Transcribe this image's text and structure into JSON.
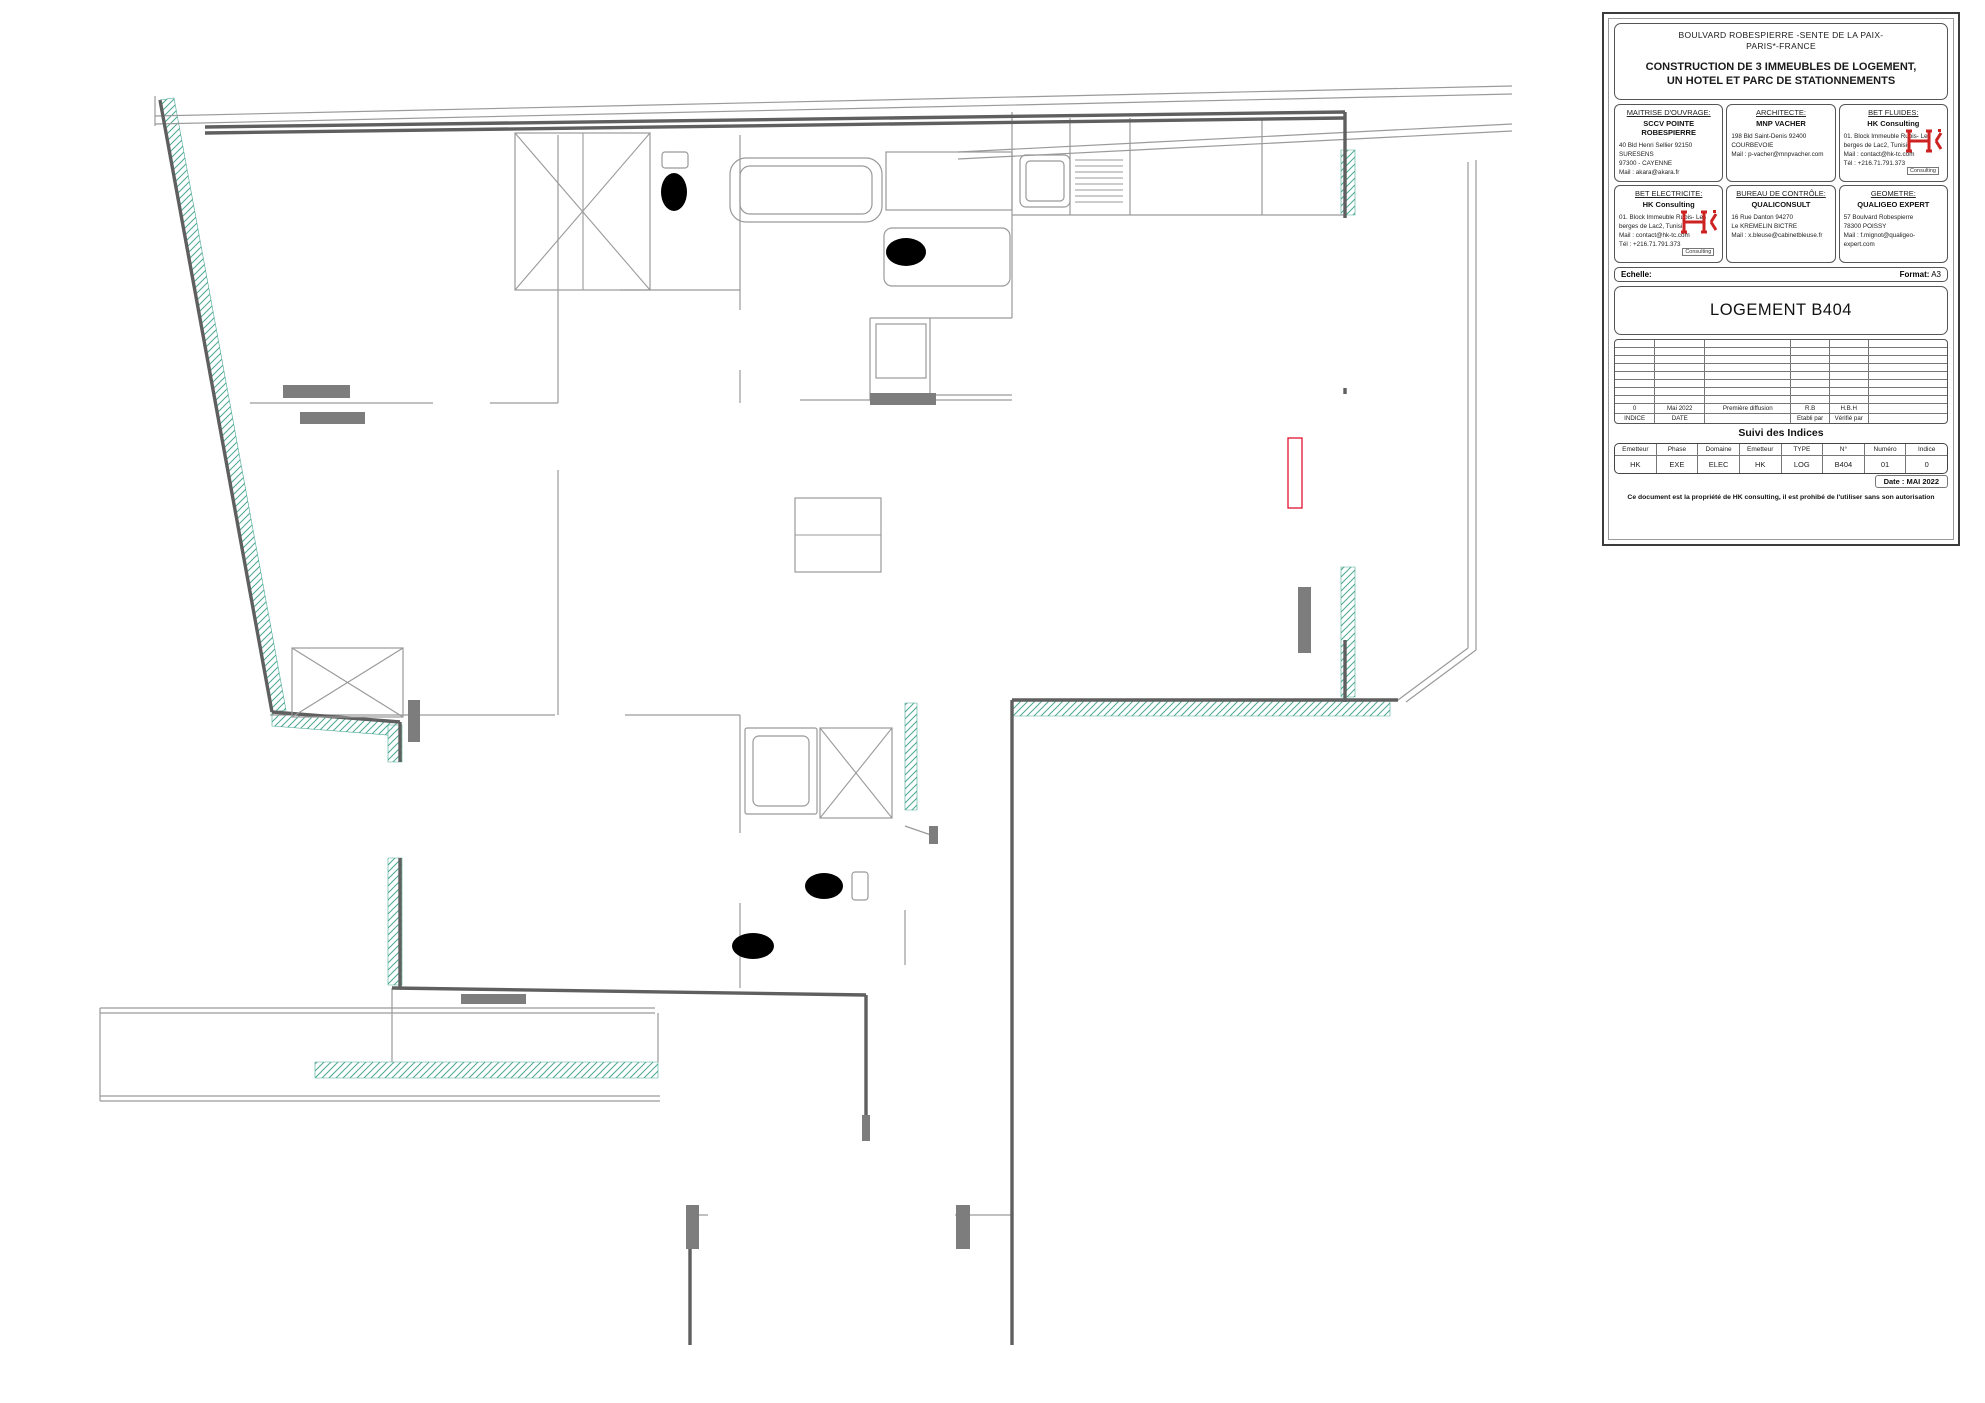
{
  "title_block": {
    "project_line1": "BOULVARD ROBESPIERRE -SENTE DE LA PAIX-",
    "project_line2": "PARIS*-FRANCE",
    "project_title1": "CONSTRUCTION DE 3 IMMEUBLES DE LOGEMENT,",
    "project_title2": "UN HOTEL ET PARC DE STATIONNEMENTS",
    "stakeholders": [
      {
        "role": "MAITRISE D'OUVRAGE:",
        "name": "SCCV POINTE ROBESPIERRE",
        "lines": [
          "40 Bld Henri Sellier 92150 SURESENS",
          "97300 - CAYENNE",
          "Mail : akara@akara.fr"
        ],
        "logo": false
      },
      {
        "role": "ARCHITECTE:",
        "name": "MNP VACHER",
        "lines": [
          "198 Bld Saint-Denis 92400",
          "COURBEVOIE",
          "Mail : p-vacher@mnpvacher.com"
        ],
        "logo": false
      },
      {
        "role": "BET FLUIDES:",
        "name": "HK Consulting",
        "lines": [
          "01. Block Immeuble Rubis- Les",
          "berges de Lac2, Tunisie",
          "Mail : contact@hk-tc.com",
          "Tél : +216.71.791.373"
        ],
        "logo": true
      },
      {
        "role": "BET ELECTRICITE:",
        "name": "HK Consulting",
        "lines": [
          "01. Block Immeuble Rubis- Les",
          "berges de Lac2, Tunisie",
          "Mail : contact@hk-tc.com",
          "Tél : +216.71.791.373"
        ],
        "logo": true
      },
      {
        "role": "BUREAU DE CONTRÔLE:",
        "name": "QUALICONSULT",
        "lines": [
          "16 Rue Danton 94270",
          "Le KREMELIN BICTRE",
          "Mail : x.bleuse@cabinetbleuse.fr"
        ],
        "logo": false
      },
      {
        "role": "GEOMETRE:",
        "name": "QUALIGEO EXPERT",
        "lines": [
          "57 Boulvard Robespierre",
          "78300 POISSY",
          "Mail : f.mignot@qualigeo-expert.com"
        ],
        "logo": false
      }
    ],
    "logo_text": "Consulting",
    "echelle_label": "Echelle:",
    "format_label": "Format:",
    "format_value": "A3",
    "drawing_title": "LOGEMENT B404",
    "revision_filled": [
      "0",
      "Mai 2022",
      "Première diffusion",
      "R.B",
      "H.B.H",
      ""
    ],
    "revision_headers": [
      "INDICE",
      "DATE",
      "",
      "Etabli par",
      "Vérifié par",
      ""
    ],
    "suivi_title": "Suivi des Indices",
    "suivi_headers": [
      "Emetteur",
      "Phase",
      "Domaine",
      "Emetteur",
      "TYPE",
      "N°",
      "Numéro",
      "Indice"
    ],
    "suivi_values": [
      "HK",
      "EXE",
      "ELEC",
      "HK",
      "LOG",
      "B404",
      "01",
      "0"
    ],
    "date_label": "Date : MAI 2022",
    "footer": "Ce document est la propriété de HK consulting, il est prohibé de l'utiliser sans son autorisation"
  },
  "plan": {
    "rooms": [
      {
        "t": "CHAMBRE 3",
        "x": 318,
        "y": 290
      },
      {
        "t": "WC",
        "x": 628,
        "y": 203
      },
      {
        "t": "SdB",
        "x": 813,
        "y": 278
      },
      {
        "t": "CUISINE",
        "x": 1138,
        "y": 279
      },
      {
        "t": "BALCON",
        "x": 1428,
        "y": 349
      },
      {
        "t": "CHAMBRE 2",
        "x": 392,
        "y": 521
      },
      {
        "t": "DEGT",
        "x": 634,
        "y": 412
      },
      {
        "t": "SEJOUR",
        "x": 1007,
        "y": 509
      },
      {
        "t": "CHAMBRE 1",
        "x": 561,
        "y": 773
      },
      {
        "t": "SdE",
        "x": 777,
        "y": 853
      },
      {
        "t": "ENTREE",
        "x": 944,
        "y": 970
      }
    ],
    "dims": [
      {
        "t": "1247.00",
        "x": 401,
        "y": 213,
        "a": -62
      },
      {
        "t": "1147.00",
        "x": 588,
        "y": 203,
        "a": -62
      },
      {
        "t": "679.00",
        "x": 643,
        "y": 189,
        "a": -55
      },
      {
        "t": "1151.00",
        "x": 549,
        "y": 345,
        "a": -62
      },
      {
        "t": "2095.00",
        "x": 646,
        "y": 315,
        "a": -55
      },
      {
        "t": "94.00",
        "x": 684,
        "y": 347,
        "a": -45
      },
      {
        "t": "4430.00",
        "x": 591,
        "y": 358,
        "a": -80
      },
      {
        "t": "446.00",
        "x": 674,
        "y": 431,
        "a": -45
      },
      {
        "t": "1062.00",
        "x": 701,
        "y": 444,
        "a": -80
      },
      {
        "t": "1060.00",
        "x": 723,
        "y": 447,
        "a": -80
      },
      {
        "t": "1248.00",
        "x": 719,
        "y": 549,
        "a": -62
      },
      {
        "t": "1265.50",
        "x": 868,
        "y": 293,
        "a": -28
      },
      {
        "t": "737.50",
        "x": 979,
        "y": 320,
        "a": -62
      },
      {
        "t": "901.00",
        "x": 805,
        "y": 337,
        "a": -80
      },
      {
        "t": "229.00",
        "x": 1022,
        "y": 374,
        "a": -45
      },
      {
        "t": "1523.00",
        "x": 1147,
        "y": 183,
        "a": -35
      },
      {
        "t": "1204.00",
        "x": 1110,
        "y": 207,
        "a": -35
      },
      {
        "t": "694.00",
        "x": 1250,
        "y": 173,
        "a": -45
      },
      {
        "t": "475.00",
        "x": 1302,
        "y": 172,
        "a": -55
      },
      {
        "t": "525.00",
        "x": 1013,
        "y": 137,
        "a": -40
      },
      {
        "t": "2014.00",
        "x": 1233,
        "y": 282,
        "a": -35
      },
      {
        "t": "347.00",
        "x": 1001,
        "y": 654,
        "a": -62
      },
      {
        "t": "1077.00",
        "x": 1072,
        "y": 650,
        "a": -28
      },
      {
        "t": "1671.00",
        "x": 980,
        "y": 604,
        "a": -80
      },
      {
        "t": "812.00",
        "x": 829,
        "y": 692,
        "a": -28
      },
      {
        "t": "1013.00",
        "x": 1287,
        "y": 632,
        "a": -78
      },
      {
        "t": "801.00",
        "x": 1350,
        "y": 424,
        "a": -78
      },
      {
        "t": "1790.00",
        "x": 480,
        "y": 801,
        "a": -25
      },
      {
        "t": "755.00",
        "x": 431,
        "y": 956,
        "a": -45
      },
      {
        "t": "3565.00",
        "x": 598,
        "y": 827,
        "a": -62
      },
      {
        "t": "919.50",
        "x": 711,
        "y": 944,
        "a": -62
      },
      {
        "t": "1034.50",
        "x": 767,
        "y": 920,
        "a": -62
      },
      {
        "t": "2199.00",
        "x": 881,
        "y": 857,
        "a": -25
      },
      {
        "t": "459.00",
        "x": 964,
        "y": 901,
        "a": -62
      },
      {
        "t": "654.50",
        "x": 898,
        "y": 973,
        "a": -45
      },
      {
        "t": "654.50",
        "x": 901,
        "y": 1031,
        "a": -45
      },
      {
        "t": "2518.50",
        "x": 925,
        "y": 1092,
        "a": -70
      },
      {
        "t": "923.50",
        "x": 931,
        "y": 1271,
        "a": -70
      }
    ],
    "labels": [
      {
        "t": "PF",
        "x": 228,
        "y": 288,
        "a": -80,
        "c": "dg",
        "s": 20,
        "i": 1,
        "b": 1
      },
      {
        "t": "VR",
        "x": 251,
        "y": 282,
        "a": -80,
        "c": "dg",
        "s": 12
      },
      {
        "t": "PF100x215 GC",
        "x": 207,
        "y": 325,
        "a": -80,
        "c": "r",
        "s": 11,
        "box": 1
      },
      {
        "t": "VR",
        "x": 188,
        "y": 371,
        "c": "b",
        "s": 11,
        "box": 1
      },
      {
        "t": "PF",
        "x": 250,
        "y": 458,
        "a": -80,
        "c": "dg",
        "s": 20,
        "i": 1,
        "b": 1
      },
      {
        "t": "VR",
        "x": 273,
        "y": 455,
        "a": -80,
        "c": "dg",
        "s": 12
      },
      {
        "t": "PF100x215 GC",
        "x": 228,
        "y": 494,
        "a": -80,
        "c": "r",
        "s": 11,
        "box": 1
      },
      {
        "t": "PF",
        "x": 393,
        "y": 780,
        "a": -87,
        "c": "dg",
        "s": 20,
        "i": 1,
        "b": 1
      },
      {
        "t": "VR",
        "x": 414,
        "y": 777,
        "a": -87,
        "c": "dg",
        "s": 12
      },
      {
        "t": "PF100x215 GC",
        "x": 368,
        "y": 812,
        "a": -87,
        "c": "r",
        "s": 11,
        "box": 1
      },
      {
        "t": "EP",
        "x": 327,
        "y": 752,
        "a": 180,
        "c": "g",
        "s": 11
      },
      {
        "t": "VR",
        "x": 1284,
        "y": 222,
        "c": "b",
        "s": 11,
        "box": 1
      },
      {
        "t": "PF",
        "x": 1324,
        "y": 297,
        "a": -90,
        "c": "dg",
        "s": 18,
        "i": 1,
        "b": 1
      },
      {
        "t": "VR",
        "x": 1303,
        "y": 299,
        "a": -90,
        "c": "dg",
        "s": 12
      },
      {
        "t": "PF100 BALCON",
        "x": 1350,
        "y": 262,
        "a": -90,
        "c": "r",
        "s": 11
      },
      {
        "t": "VR",
        "x": 1281,
        "y": 534,
        "c": "b",
        "s": 11,
        "box": 1
      },
      {
        "t": "VR",
        "x": 1306,
        "y": 557,
        "a": -75,
        "c": "dg",
        "s": 12
      },
      {
        "t": "PF",
        "x": 1326,
        "y": 554,
        "a": -75,
        "c": "dg",
        "s": 18,
        "i": 1,
        "b": 1
      },
      {
        "t": "PF200",
        "x": 1352,
        "y": 487,
        "a": -90,
        "c": "r",
        "s": 11
      },
      {
        "t": "PARE-VUE",
        "x": 1418,
        "y": 100,
        "a": 180,
        "c": "g",
        "s": 14
      },
      {
        "t": "PARE-VUE",
        "x": 1406,
        "y": 131,
        "a": 180,
        "c": "g",
        "s": 14
      },
      {
        "t": "Siphon",
        "x": 1383,
        "y": 152,
        "a": 180,
        "c": "g",
        "s": 10
      },
      {
        "t": "EP+",
        "x": 1376,
        "y": 163,
        "a": 180,
        "c": "g",
        "s": 10
      },
      {
        "t": "Siphon",
        "x": 1378,
        "y": 645,
        "a": 180,
        "c": "g",
        "s": 10
      },
      {
        "t": "EP+",
        "x": 1371,
        "y": 656,
        "a": 180,
        "c": "g",
        "s": 10
      },
      {
        "t": "LIMITE CARRELAGE",
        "x": 1121,
        "y": 319,
        "a": 180,
        "c": "g",
        "s": 11
      },
      {
        "t": "GT B01",
        "x": 919,
        "y": 206,
        "a": 180,
        "c": "g",
        "s": 13
      },
      {
        "t": "VMC",
        "x": 893,
        "y": 170,
        "a": 180,
        "c": "g",
        "s": 10
      },
      {
        "t": "LGM",
        "x": 893,
        "y": 181,
        "a": 180,
        "c": "g",
        "s": 10
      },
      {
        "t": "VMC",
        "x": 700,
        "y": 203,
        "a": -90,
        "c": "g",
        "s": 10
      },
      {
        "t": "VMC",
        "x": 986,
        "y": 198,
        "a": -90,
        "c": "g",
        "s": 10
      },
      {
        "t": "VMC",
        "x": 757,
        "y": 941,
        "a": -90,
        "c": "g",
        "s": 10
      },
      {
        "t": "LL",
        "x": 901,
        "y": 350,
        "c": "g",
        "s": 13
      },
      {
        "t": "GT B02",
        "x": 642,
        "y": 948,
        "a": -90,
        "c": "g",
        "s": 12
      },
      {
        "t": "GT B02",
        "x": 830,
        "y": 969,
        "a": 180,
        "c": "g",
        "s": 12
      },
      {
        "t": "P.P 81",
        "x": 572,
        "y": 358,
        "a": -90,
        "c": "dg",
        "s": 10
      },
      {
        "t": "P.P 81",
        "x": 572,
        "y": 451,
        "a": -90,
        "c": "dg",
        "s": 10
      },
      {
        "t": "P.P 81",
        "x": 623,
        "y": 289,
        "c": "dg",
        "s": 10
      },
      {
        "t": "P.P 81",
        "x": 707,
        "y": 328,
        "a": -90,
        "c": "dg",
        "s": 10
      },
      {
        "t": "P.P 81",
        "x": 713,
        "y": 443,
        "a": -90,
        "c": "dg",
        "s": 10
      },
      {
        "t": "P.P 81",
        "x": 708,
        "y": 874,
        "a": -90,
        "c": "dg",
        "s": 10
      },
      {
        "t": "P.P 91",
        "x": 911,
        "y": 831,
        "c": "dg",
        "s": 10
      },
      {
        "t": "P.Palière P 93",
        "x": 916,
        "y": 1208,
        "c": "dg",
        "s": 12
      },
      {
        "t": "T4",
        "x": 925,
        "y": 707,
        "a": 180,
        "c": "g",
        "s": 27,
        "b": 1
      },
      {
        "t": "B404",
        "x": 918,
        "y": 1262,
        "c": "g",
        "s": 31,
        "b": 1,
        "i": 1
      }
    ],
    "symbols": [
      {
        "k": "out",
        "x": 275,
        "y": 170,
        "a": -4
      },
      {
        "k": "out",
        "x": 428,
        "y": 167,
        "a": -4
      },
      {
        "k": "sw",
        "x": 450,
        "y": 167
      },
      {
        "k": "out",
        "x": 332,
        "y": 417
      },
      {
        "k": "out",
        "x": 483,
        "y": 417
      },
      {
        "k": "out",
        "x": 545,
        "y": 662
      },
      {
        "k": "sw",
        "x": 566,
        "y": 663
      },
      {
        "k": "out",
        "x": 600,
        "y": 591
      },
      {
        "k": "sw",
        "x": 600,
        "y": 572
      },
      {
        "k": "out",
        "x": 720,
        "y": 490,
        "a": 90
      },
      {
        "k": "out",
        "x": 723,
        "y": 608,
        "a": 90
      },
      {
        "k": "out",
        "x": 789,
        "y": 706
      },
      {
        "k": "out",
        "x": 1020,
        "y": 671
      },
      {
        "k": "sw",
        "x": 1122,
        "y": 671
      },
      {
        "k": "out",
        "x": 1141,
        "y": 671
      },
      {
        "k": "sw",
        "x": 1160,
        "y": 671
      },
      {
        "k": "out",
        "x": 1181,
        "y": 671
      },
      {
        "k": "out",
        "x": 1210,
        "y": 164
      },
      {
        "k": "out",
        "x": 1227,
        "y": 164
      },
      {
        "k": "out",
        "x": 1281,
        "y": 164
      },
      {
        "k": "sqb",
        "x": 1010,
        "y": 164,
        "t": "LV"
      },
      {
        "k": "sqb",
        "x": 1133,
        "y": 163,
        "t": "H"
      },
      {
        "k": "sqb",
        "x": 1155,
        "y": 163,
        "t": "32A"
      },
      {
        "k": "sqb",
        "x": 1178,
        "y": 163,
        "t": "F"
      },
      {
        "k": "sqb",
        "x": 909,
        "y": 366,
        "t": "T1"
      },
      {
        "k": "out",
        "x": 640,
        "y": 965
      },
      {
        "k": "out",
        "x": 806,
        "y": 975
      },
      {
        "k": "sw",
        "x": 463,
        "y": 966
      },
      {
        "k": "out",
        "x": 485,
        "y": 966
      },
      {
        "k": "out",
        "x": 541,
        "y": 1000
      },
      {
        "k": "out",
        "x": 983,
        "y": 794,
        "a": 90
      },
      {
        "k": "out",
        "x": 982,
        "y": 925,
        "a": 90
      },
      {
        "k": "lt",
        "x": 400,
        "y": 272
      },
      {
        "k": "lt",
        "x": 648,
        "y": 220
      },
      {
        "k": "lt",
        "x": 814,
        "y": 295
      },
      {
        "k": "lt",
        "x": 1137,
        "y": 266
      },
      {
        "k": "lt",
        "x": 437,
        "y": 533
      },
      {
        "k": "lt",
        "x": 993,
        "y": 529
      },
      {
        "k": "lt",
        "x": 559,
        "y": 815
      },
      {
        "k": "ltx",
        "x": 645,
        "y": 452
      },
      {
        "k": "ltx",
        "x": 787,
        "y": 871
      },
      {
        "k": "ltx",
        "x": 932,
        "y": 1020
      },
      {
        "k": "ltr",
        "x": 648,
        "y": 398
      },
      {
        "k": "ltrx",
        "x": 930,
        "y": 975
      },
      {
        "k": "spot",
        "x": 587,
        "y": 262
      },
      {
        "k": "spot",
        "x": 1037,
        "y": 256
      },
      {
        "k": "spot",
        "x": 784,
        "y": 960
      },
      {
        "k": "wl",
        "x": 527,
        "y": 232
      },
      {
        "k": "wl",
        "x": 556,
        "y": 297
      },
      {
        "k": "wl",
        "x": 851,
        "y": 201
      },
      {
        "k": "wl",
        "x": 903,
        "y": 262
      },
      {
        "k": "wl",
        "x": 640,
        "y": 788
      },
      {
        "k": "wl",
        "x": 739,
        "y": 962
      },
      {
        "k": "lamp",
        "x": 556,
        "y": 298
      },
      {
        "k": "lamp",
        "x": 604,
        "y": 382
      },
      {
        "k": "lamp",
        "x": 703,
        "y": 950
      },
      {
        "k": "lamp",
        "x": 920,
        "y": 1236
      },
      {
        "k": "lamp",
        "x": 1289,
        "y": 585
      },
      {
        "k": "tri",
        "x": 695,
        "y": 206
      },
      {
        "k": "tri",
        "x": 980,
        "y": 206
      },
      {
        "k": "bell",
        "x": 978,
        "y": 1200
      },
      {
        "k": "scircle",
        "x": 987,
        "y": 1274
      },
      {
        "k": "pt",
        "x": 935,
        "y": 1315
      },
      {
        "k": "keypad",
        "x": 888,
        "y": 1102
      },
      {
        "k": "halfdisc",
        "x": 1347,
        "y": 466
      },
      {
        "k": "ghost-out",
        "x": 188,
        "y": 126
      },
      {
        "k": "ghost-out",
        "x": 432,
        "y": 122
      }
    ]
  }
}
